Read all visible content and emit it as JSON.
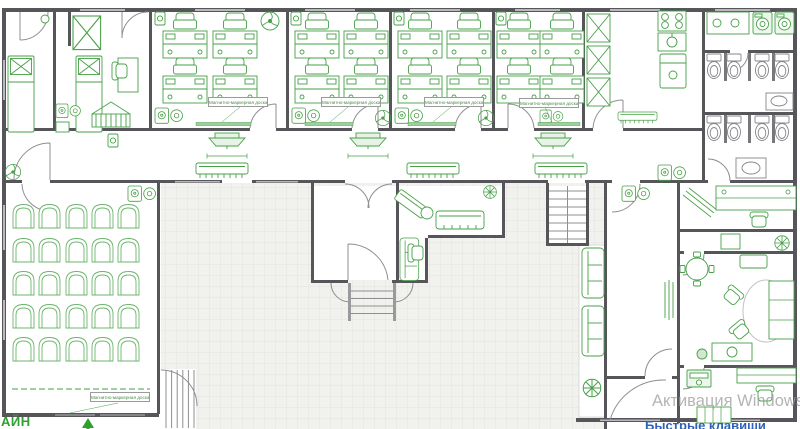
{
  "plan": {
    "board_label": "Магнитно-маркерная доска"
  },
  "watermark": {
    "activation_text": "Активация Windows",
    "shortcut_link_text": "Быстрые клавиши"
  },
  "branding": {
    "logo_text_fragment": "АЙН"
  },
  "colors": {
    "drawing_green": "#47a047",
    "wall_gray": "#55555a",
    "tile_floor": "#f1f1ee",
    "watermark_gray": "#9b9b9b",
    "shortcut_blue": "#2d62b8"
  }
}
